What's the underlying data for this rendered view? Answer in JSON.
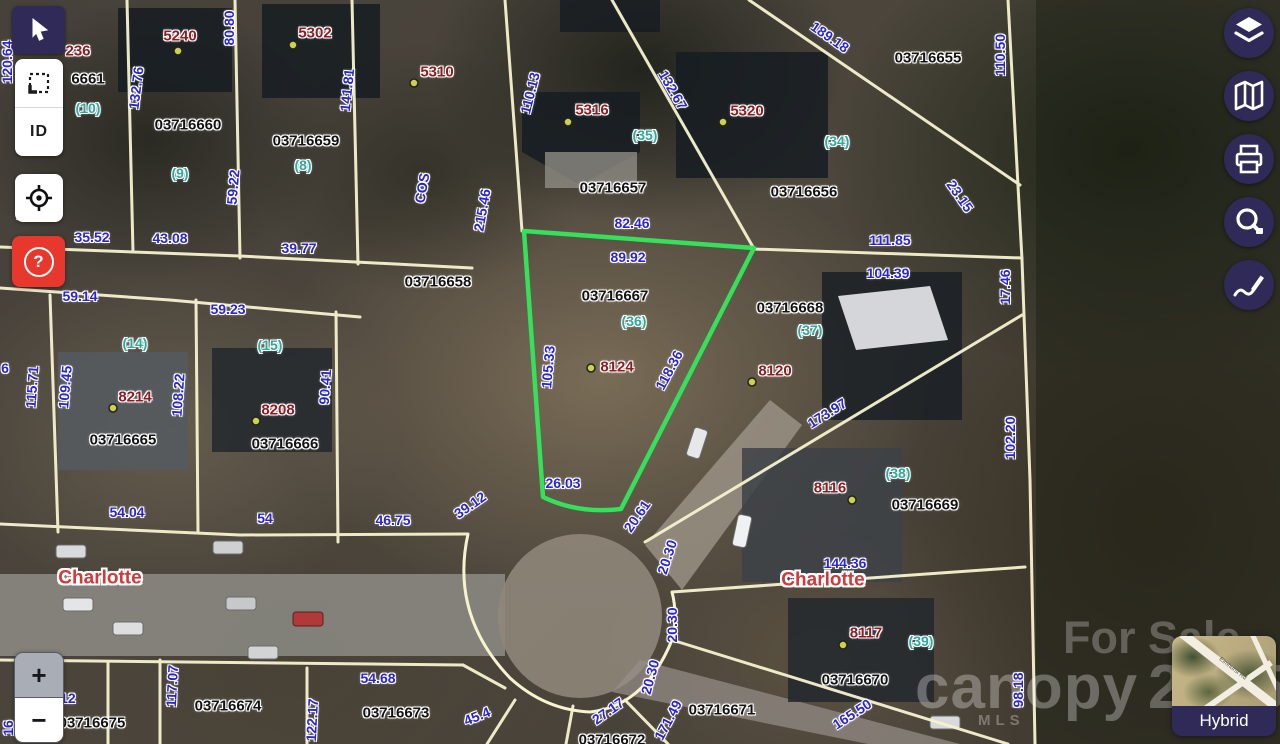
{
  "ui": {
    "toolbar_left": {
      "buttons": [
        {
          "name": "pointer",
          "active": true
        },
        {
          "name": "marquee-select"
        },
        {
          "name": "identify",
          "label": "ID"
        },
        {
          "name": "locate"
        },
        {
          "name": "help",
          "label": "?"
        }
      ]
    },
    "toolbar_right": {
      "buttons": [
        {
          "name": "layers"
        },
        {
          "name": "basemap-gallery"
        },
        {
          "name": "print"
        },
        {
          "name": "measure"
        },
        {
          "name": "draw"
        }
      ]
    },
    "zoom_controls": {
      "zoom_in": "+",
      "zoom_out": "−"
    },
    "basemap_selector": {
      "label": "Hybrid",
      "thumbnail_road": "Elmhurst Rd"
    },
    "watermarks": {
      "line1": "For Sale",
      "brand": "canopy",
      "brand_sub": "MLS",
      "year": "2025"
    }
  },
  "colors": {
    "dimension": "#2b26c9",
    "parcel_id": "#121212",
    "address": "#8c1d22",
    "lot_number": "#2fa89d",
    "city_label": "#cf3a3a",
    "parcel_line": "#f7f3cf",
    "selected_outline": "#35e05a",
    "toolbar_purple": "#2f2a57",
    "help_red": "#e8382d",
    "address_dot": "#cdd24a"
  },
  "map": {
    "labels": [
      {
        "t": "236",
        "x": 78,
        "y": 51,
        "r": 0,
        "k": "addr"
      },
      {
        "t": "6661",
        "x": 88,
        "y": 79,
        "r": 0,
        "k": "id"
      },
      {
        "t": "(10)",
        "x": 88,
        "y": 108,
        "r": 0,
        "k": "lot"
      },
      {
        "t": "120.64",
        "x": 7,
        "y": 62,
        "r": -90,
        "k": "dim"
      },
      {
        "t": "5240",
        "x": 180,
        "y": 36,
        "r": 0,
        "k": "addr"
      },
      {
        "t": "5302",
        "x": 315,
        "y": 33,
        "r": 0,
        "k": "addr"
      },
      {
        "t": "5310",
        "x": 437,
        "y": 72,
        "r": 0,
        "k": "addr"
      },
      {
        "t": "80.80",
        "x": 229,
        "y": 28,
        "r": -90,
        "k": "dim"
      },
      {
        "t": "132.76",
        "x": 136,
        "y": 88,
        "r": -83,
        "k": "dim"
      },
      {
        "t": "141.81",
        "x": 347,
        "y": 90,
        "r": -84,
        "k": "dim"
      },
      {
        "t": "110.13",
        "x": 530,
        "y": 93,
        "r": -76,
        "k": "dim"
      },
      {
        "t": "132.67",
        "x": 673,
        "y": 90,
        "r": 60,
        "k": "dim"
      },
      {
        "t": "189.18",
        "x": 830,
        "y": 37,
        "r": 35,
        "k": "dim"
      },
      {
        "t": "03716655",
        "x": 928,
        "y": 58,
        "r": 0,
        "k": "id"
      },
      {
        "t": "110.50",
        "x": 1000,
        "y": 55,
        "r": -90,
        "k": "dim"
      },
      {
        "t": "03716660",
        "x": 188,
        "y": 125,
        "r": 0,
        "k": "id"
      },
      {
        "t": "03716659",
        "x": 306,
        "y": 141,
        "r": 0,
        "k": "id"
      },
      {
        "t": "(9)",
        "x": 180,
        "y": 173,
        "r": 0,
        "k": "lot"
      },
      {
        "t": "(8)",
        "x": 303,
        "y": 165,
        "r": 0,
        "k": "lot"
      },
      {
        "t": "59.22",
        "x": 233,
        "y": 187,
        "r": -85,
        "k": "dim"
      },
      {
        "t": "COS",
        "x": 422,
        "y": 188,
        "r": -80,
        "k": "dim"
      },
      {
        "t": "5316",
        "x": 592,
        "y": 110,
        "r": 0,
        "k": "addr"
      },
      {
        "t": "(35)",
        "x": 645,
        "y": 135,
        "r": 0,
        "k": "lot"
      },
      {
        "t": "5320",
        "x": 747,
        "y": 111,
        "r": 0,
        "k": "addr"
      },
      {
        "t": "(34)",
        "x": 837,
        "y": 141,
        "r": 0,
        "k": "lot"
      },
      {
        "t": "03716657",
        "x": 613,
        "y": 188,
        "r": 0,
        "k": "id"
      },
      {
        "t": "03716656",
        "x": 804,
        "y": 192,
        "r": 0,
        "k": "id"
      },
      {
        "t": "23.15",
        "x": 960,
        "y": 196,
        "r": 55,
        "k": "dim"
      },
      {
        "t": "35.52",
        "x": 92,
        "y": 237,
        "r": 0,
        "k": "dim"
      },
      {
        "t": "43.08",
        "x": 170,
        "y": 238,
        "r": 0,
        "k": "dim"
      },
      {
        "t": "39.77",
        "x": 299,
        "y": 248,
        "r": 0,
        "k": "dim"
      },
      {
        "t": "1",
        "x": 20,
        "y": 214,
        "r": 0,
        "k": "dim"
      },
      {
        "t": "215.46",
        "x": 482,
        "y": 210,
        "r": -80,
        "k": "dim"
      },
      {
        "t": "82.46",
        "x": 632,
        "y": 223,
        "r": 0,
        "k": "dim"
      },
      {
        "t": "89.92",
        "x": 628,
        "y": 257,
        "r": 0,
        "k": "dim"
      },
      {
        "t": "111.85",
        "x": 890,
        "y": 240,
        "r": 0,
        "k": "dim"
      },
      {
        "t": "104.39",
        "x": 888,
        "y": 273,
        "r": 0,
        "k": "dim"
      },
      {
        "t": "17.46",
        "x": 1005,
        "y": 287,
        "r": -90,
        "k": "dim"
      },
      {
        "t": "03716658",
        "x": 438,
        "y": 282,
        "r": 0,
        "k": "id"
      },
      {
        "t": "03716667",
        "x": 615,
        "y": 296,
        "r": 0,
        "k": "id"
      },
      {
        "t": "(36)",
        "x": 634,
        "y": 321,
        "r": 0,
        "k": "lot"
      },
      {
        "t": "03716668",
        "x": 790,
        "y": 308,
        "r": 0,
        "k": "id"
      },
      {
        "t": "(37)",
        "x": 810,
        "y": 330,
        "r": 0,
        "k": "lot"
      },
      {
        "t": "59.14",
        "x": 80,
        "y": 296,
        "r": 0,
        "k": "dim"
      },
      {
        "t": "59.23",
        "x": 228,
        "y": 309,
        "r": 0,
        "k": "dim"
      },
      {
        "t": "(14)",
        "x": 135,
        "y": 343,
        "r": 0,
        "k": "lot"
      },
      {
        "t": "(15)",
        "x": 270,
        "y": 345,
        "r": 0,
        "k": "lot"
      },
      {
        "t": "8124",
        "x": 617,
        "y": 367,
        "r": 0,
        "k": "addr"
      },
      {
        "t": "105.33",
        "x": 548,
        "y": 367,
        "r": -85,
        "k": "dim"
      },
      {
        "t": "118.36",
        "x": 669,
        "y": 370,
        "r": -62,
        "k": "dim"
      },
      {
        "t": "8120",
        "x": 775,
        "y": 371,
        "r": 0,
        "k": "addr"
      },
      {
        "t": "173.97",
        "x": 827,
        "y": 413,
        "r": -32,
        "k": "dim"
      },
      {
        "t": "102.20",
        "x": 1010,
        "y": 438,
        "r": -90,
        "k": "dim"
      },
      {
        "t": "115.71",
        "x": 32,
        "y": 387,
        "r": -86,
        "k": "dim"
      },
      {
        "t": "109.45",
        "x": 65,
        "y": 387,
        "r": -85,
        "k": "dim"
      },
      {
        "t": "108.22",
        "x": 178,
        "y": 395,
        "r": -86,
        "k": "dim"
      },
      {
        "t": "90.41",
        "x": 325,
        "y": 387,
        "r": -86,
        "k": "dim"
      },
      {
        "t": "8214",
        "x": 135,
        "y": 397,
        "r": 0,
        "k": "addr"
      },
      {
        "t": "8208",
        "x": 278,
        "y": 410,
        "r": 0,
        "k": "addr"
      },
      {
        "t": "6",
        "x": 5,
        "y": 368,
        "r": 0,
        "k": "dim"
      },
      {
        "t": "03716665",
        "x": 123,
        "y": 440,
        "r": 0,
        "k": "id"
      },
      {
        "t": "03716666",
        "x": 285,
        "y": 444,
        "r": 0,
        "k": "id"
      },
      {
        "t": "(38)",
        "x": 898,
        "y": 473,
        "r": 0,
        "k": "lot"
      },
      {
        "t": "8116",
        "x": 830,
        "y": 488,
        "r": 0,
        "k": "addr"
      },
      {
        "t": "03716669",
        "x": 925,
        "y": 505,
        "r": 0,
        "k": "id"
      },
      {
        "t": "54.04",
        "x": 127,
        "y": 512,
        "r": 0,
        "k": "dim"
      },
      {
        "t": "54",
        "x": 265,
        "y": 518,
        "r": 0,
        "k": "dim"
      },
      {
        "t": "46.75",
        "x": 393,
        "y": 520,
        "r": 0,
        "k": "dim"
      },
      {
        "t": "39.12",
        "x": 470,
        "y": 505,
        "r": -35,
        "k": "dim"
      },
      {
        "t": "26.03",
        "x": 563,
        "y": 483,
        "r": 0,
        "k": "dim"
      },
      {
        "t": "20.61",
        "x": 637,
        "y": 516,
        "r": -55,
        "k": "dim"
      },
      {
        "t": "20.30",
        "x": 667,
        "y": 557,
        "r": -72,
        "k": "dim"
      },
      {
        "t": "20.30",
        "x": 672,
        "y": 625,
        "r": -90,
        "k": "dim"
      },
      {
        "t": "20.30",
        "x": 650,
        "y": 677,
        "r": -75,
        "k": "dim"
      },
      {
        "t": "144.36",
        "x": 845,
        "y": 563,
        "r": 0,
        "k": "dim"
      },
      {
        "t": "Charlotte",
        "x": 823,
        "y": 580,
        "r": 0,
        "k": "city"
      },
      {
        "t": "Charlotte",
        "x": 100,
        "y": 578,
        "r": 0,
        "k": "city"
      },
      {
        "t": "8117",
        "x": 866,
        "y": 633,
        "r": 0,
        "k": "addr"
      },
      {
        "t": "(39)",
        "x": 921,
        "y": 641,
        "r": 0,
        "k": "lot"
      },
      {
        "t": "03716670",
        "x": 855,
        "y": 680,
        "r": 0,
        "k": "id"
      },
      {
        "t": "98.18",
        "x": 1018,
        "y": 690,
        "r": -90,
        "k": "dim"
      },
      {
        "t": "165.50",
        "x": 852,
        "y": 714,
        "r": -33,
        "k": "dim"
      },
      {
        "t": "03716671",
        "x": 722,
        "y": 710,
        "r": 0,
        "k": "id"
      },
      {
        "t": "171.49",
        "x": 668,
        "y": 720,
        "r": -62,
        "k": "dim"
      },
      {
        "t": "27.17",
        "x": 608,
        "y": 711,
        "r": -35,
        "k": "dim"
      },
      {
        "t": "03716672",
        "x": 612,
        "y": 740,
        "r": 0,
        "k": "id"
      },
      {
        "t": "54.68",
        "x": 378,
        "y": 678,
        "r": 0,
        "k": "dim"
      },
      {
        "t": "03716673",
        "x": 396,
        "y": 713,
        "r": 0,
        "k": "id"
      },
      {
        "t": "45.4",
        "x": 477,
        "y": 716,
        "r": -22,
        "k": "dim"
      },
      {
        "t": "117.07",
        "x": 172,
        "y": 686,
        "r": -87,
        "k": "dim"
      },
      {
        "t": "03716674",
        "x": 228,
        "y": 706,
        "r": 0,
        "k": "id"
      },
      {
        "t": "122.17",
        "x": 312,
        "y": 720,
        "r": -87,
        "k": "dim"
      },
      {
        "t": "4.12",
        "x": 62,
        "y": 698,
        "r": 0,
        "k": "dim"
      },
      {
        "t": "03716675",
        "x": 92,
        "y": 723,
        "r": 0,
        "k": "id"
      },
      {
        "t": "16",
        "x": 8,
        "y": 728,
        "r": -90,
        "k": "dim"
      }
    ],
    "address_dots": [
      [
        178,
        51
      ],
      [
        293,
        45
      ],
      [
        414,
        83
      ],
      [
        568,
        122
      ],
      [
        723,
        122
      ],
      [
        591,
        368
      ],
      [
        752,
        382
      ],
      [
        113,
        408
      ],
      [
        256,
        421
      ],
      [
        852,
        500
      ],
      [
        843,
        645
      ]
    ]
  }
}
